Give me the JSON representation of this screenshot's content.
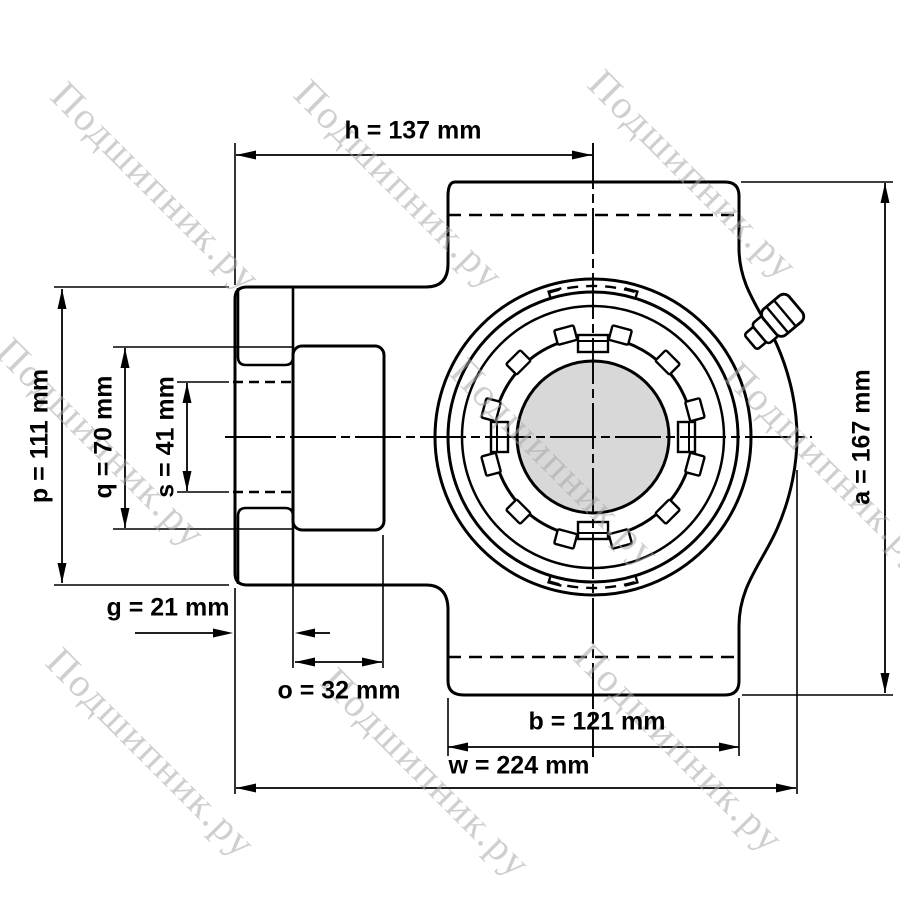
{
  "title": "Take-up bearing unit technical drawing",
  "watermark": {
    "text": "Подшипник.ру",
    "color": "#c7c7c7"
  },
  "dimensions": {
    "h": {
      "label": "h = 137 mm",
      "value": 137,
      "unit": "mm"
    },
    "p": {
      "label": "p = 111 mm",
      "value": 111,
      "unit": "mm"
    },
    "q": {
      "label": "q = 70 mm",
      "value": 70,
      "unit": "mm"
    },
    "s": {
      "label": "s = 41 mm",
      "value": 41,
      "unit": "mm"
    },
    "g": {
      "label": "g = 21 mm",
      "value": 21,
      "unit": "mm"
    },
    "o": {
      "label": "o = 32 mm",
      "value": 32,
      "unit": "mm"
    },
    "b": {
      "label": "b = 121 mm",
      "value": 121,
      "unit": "mm"
    },
    "w": {
      "label": "w = 224 mm",
      "value": 224,
      "unit": "mm"
    },
    "a": {
      "label": "a = 167 mm",
      "value": 167,
      "unit": "mm"
    }
  },
  "colors": {
    "line": "#000000",
    "bore_fill": "#d8d8d8",
    "background": "#ffffff"
  }
}
